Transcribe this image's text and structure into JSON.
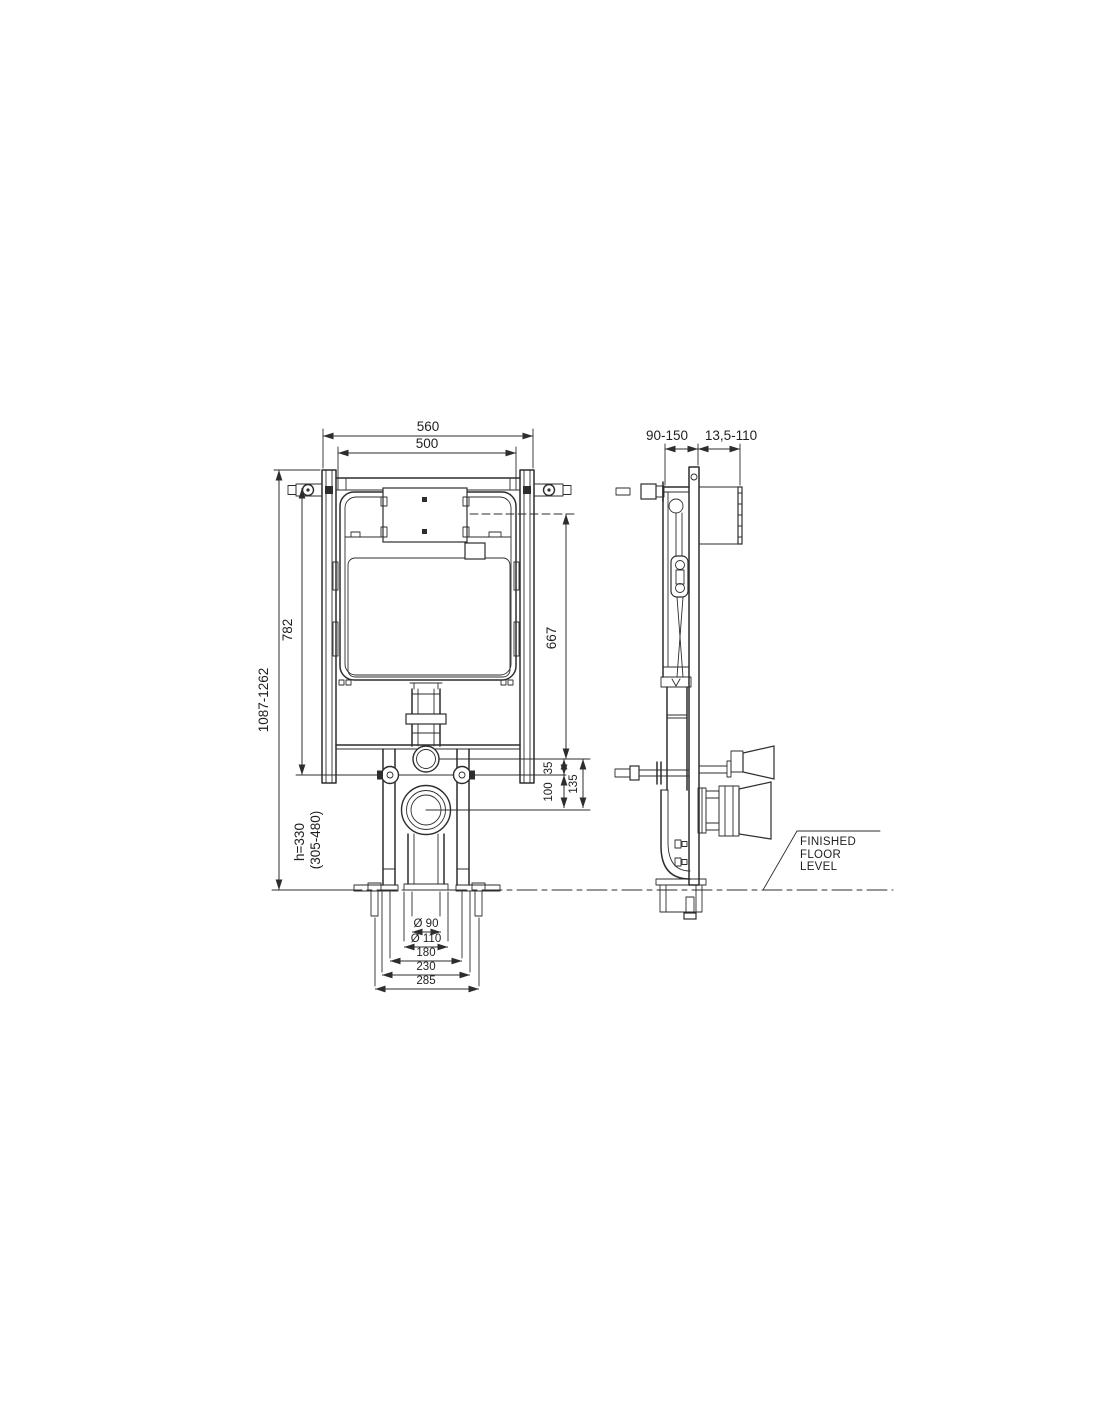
{
  "front": {
    "width_outer": "560",
    "width_tank": "500",
    "height_overall": "1087-1262",
    "height_frame": "782",
    "height_plate": "667",
    "offset_plate_bolts": "35",
    "offset_bolts_drain": "100",
    "offset_plate_drain": "135",
    "drain_height": "h=330",
    "drain_height_range": "(305-480)",
    "drain_dia_inner": "Ø 90",
    "drain_dia_outer": "Ø 110",
    "bolt_spacing": "180",
    "leg_spacing": "230",
    "anchor_spacing": "285"
  },
  "side": {
    "wall_offset": "90-150",
    "plate_depth": "13,5-110"
  },
  "floor": {
    "line1": "FINISHED",
    "line2": "FLOOR",
    "line3": "LEVEL"
  },
  "colors": {
    "line": "#2d2d2d",
    "background": "#ffffff"
  }
}
